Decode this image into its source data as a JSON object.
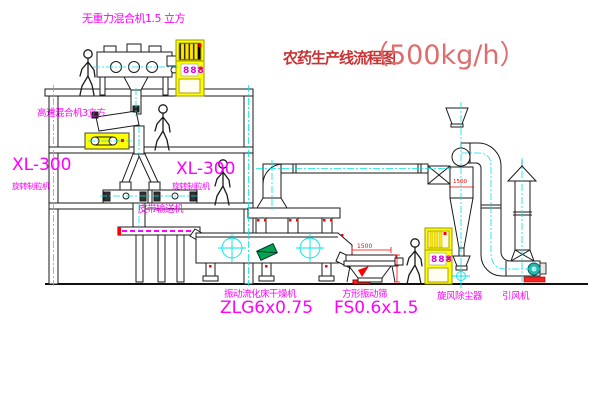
{
  "title": {
    "name_cn": "农药生产线流程图",
    "capacity": "（500kg/h）"
  },
  "equipment_labels": {
    "gravity_mixer": "无重力混合机1.5 立方",
    "high_speed_mixer": "高速混合机3立方",
    "granulator_left": {
      "model": "XL-300",
      "name": "旋转制粒机"
    },
    "granulator_right": {
      "model": "XL-300",
      "name": "旋转制粒机"
    },
    "belt_conveyor": "皮带输送机",
    "dryer": {
      "name": "振动流化床干燥机",
      "model": "ZLG6x0.75"
    },
    "screen": {
      "name": "方形振动筛",
      "model": "FS0.6x1.5"
    },
    "cyclone": "旋风除尘器",
    "fan": "引风机"
  },
  "dimensions": {
    "screen_length": "1500",
    "cyclone_marker": "1500"
  },
  "control_cabinets": {
    "top_display": "888",
    "ground_display": "888"
  },
  "colors": {
    "label_magenta": "#ff00ff",
    "title_red": "#c83232",
    "capacity_red": "#dc6e6e",
    "centerline_cyan": "#00e5e5",
    "cabinet_yellow": "#ffff00",
    "accent_red": "#ff0000",
    "plate_green": "#00a550"
  }
}
